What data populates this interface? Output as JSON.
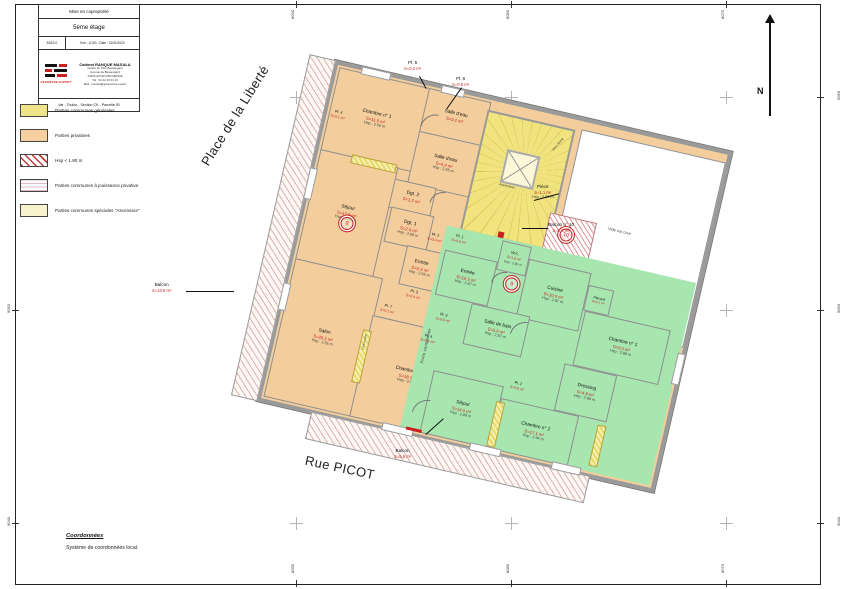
{
  "title_block": {
    "project": "Mise en copropriété",
    "floor": "5ème étage",
    "dossier": "5323.0",
    "scale_date": "Ech : 1/100 - Date : 21/01/2020",
    "firm": "Cabinet RANQUE MASALA",
    "address": [
      "Centre du Parc Beauregard",
      "Avenue de Beauregard",
      "13100 AIX EN PROVENCE",
      "Tél : 04 42 23 01 10",
      "Mail : contact@geometres.expert"
    ],
    "logo_label": "GÉOMÈTRE-EXPERT",
    "location": "Var - Toulon - Section CK - Parcelle 30"
  },
  "legend": {
    "items": [
      {
        "label": "Parties communes générales",
        "color": "#efe488"
      },
      {
        "label": "Parties privatives",
        "color": "#f5cf9e"
      },
      {
        "label": "Hsp < 1.80 m",
        "color": "hatch-red"
      },
      {
        "label": "Parties communes à jouissance privative",
        "color": "lines-pink"
      },
      {
        "label": "Parties communes spéciales \"Ascenseur\"",
        "color": "#f8f2cd"
      }
    ]
  },
  "streets": {
    "top": "Place de la Liberté",
    "bottom": "Rue PICOT"
  },
  "north_label": "N",
  "grid": {
    "x_labels": [
      "8090",
      "8080",
      "8070"
    ],
    "y_left": [
      "9050",
      "9040"
    ],
    "y_right": [
      "9060",
      "9050",
      "9040"
    ]
  },
  "coordinates_note": {
    "title": "Coordonnées",
    "text": "Système de coordonnées local."
  },
  "lots": {
    "l8": "8",
    "l9": "9",
    "l10": "10"
  },
  "labels": {
    "ascenseur": "Ascenseur",
    "vers_etage": "Vers 4ème",
    "vide": "Vide sur cour",
    "porte_condamnee": "Porte condamnée",
    "cheminee": "Cheminée"
  },
  "rooms": {
    "chambre1_o": {
      "name": "Chambre n° 1",
      "area": "S=11.5 m²",
      "hsp": "Hsp : 2.56 m"
    },
    "salle_eau1": {
      "name": "Salle d'eau",
      "area": "S=3.2 m²"
    },
    "salle_eau2": {
      "name": "Salle d'eau",
      "area": "S=4.4 m²",
      "hsp": "Hsp : 2.55 m"
    },
    "dgt2": {
      "name": "Dgt. 2",
      "area": "S=1.2 m²"
    },
    "dgt1": {
      "name": "Dgt. 1",
      "area": "S=2.9 m²",
      "hsp": "Hsp : 2.95 m"
    },
    "sejour_o": {
      "name": "Séjour",
      "area": "S=17.6 m²",
      "hsp": "Hsp : 2.56 m"
    },
    "entree_o": {
      "name": "Entrée",
      "area": "S=2.4 m²",
      "hsp": "Hsp : 2.95 m"
    },
    "salon": {
      "name": "Salon",
      "area": "S=25.2 m²",
      "hsp": "Hsp : 2.55 m"
    },
    "chambre2_o": {
      "name": "Chambre n° 2",
      "area": "S=18.1 m²",
      "hsp": "Hsp : 2.55 m"
    },
    "piece": {
      "name": "Pièce",
      "area": "S=1.1 m²",
      "hsp": "Hsp : 2.55 m"
    },
    "entree_g": {
      "name": "Entrée",
      "area": "S=10.3 m²",
      "hsp": "Hsp : 2.87 m"
    },
    "wc": {
      "name": "W.C.",
      "area": "S=1.5 m²",
      "hsp": "Hsp : 2.86 m"
    },
    "cuisine": {
      "name": "Cuisine",
      "area": "S=10.0 m²",
      "hsp": "Hsp : 2.87 m"
    },
    "placard": {
      "name": "Placard",
      "area": "S=0.1 m²"
    },
    "chambre1_g": {
      "name": "Chambre n° 1",
      "area": "S=9.2 m²",
      "hsp": "Hsp : 2.88 m"
    },
    "dressing": {
      "name": "Dressing",
      "area": "S=4.8 m²",
      "hsp": "Hsp : 2.88 m"
    },
    "salle_bain": {
      "name": "Salle de bain",
      "area": "S=5.6 m²",
      "hsp": "Hsp : 2.87 m"
    },
    "sejour_g": {
      "name": "Séjour",
      "area": "S=14.0 m²",
      "hsp": "Hsp : 2.89 m"
    },
    "chambre2_g": {
      "name": "Chambre n° 2",
      "area": "S=17.1 m²",
      "hsp": "Hsp : 2.94 m"
    }
  },
  "closets": {
    "pl4_o": {
      "name": "Pl. 4",
      "area": "S=0.1 m²"
    },
    "pl5_o": {
      "name": "Pl. 5",
      "area": "S=0.2 m²"
    },
    "pl6_o": {
      "name": "Pl. 6",
      "area": "S=0.5 m²"
    },
    "pl2_o": {
      "name": "Pl. 2",
      "area": "S=0.4 m²"
    },
    "pl3_o": {
      "name": "Pl. 3",
      "area": "S=0.4 m²"
    },
    "pl7_o": {
      "name": "Pl. 7",
      "area": "S=0.1 m²"
    },
    "pl1_g": {
      "name": "Pl. 1",
      "area": "S=0.5 m²"
    },
    "pl2_g": {
      "name": "Pl. 2",
      "area": "S=0.6 m²"
    },
    "pl3_g": {
      "name": "Pl. 3",
      "area": "S=0.6 m²"
    },
    "pl4_g": {
      "name": "Pl. 4",
      "area": "S=0.5 m²"
    }
  },
  "balconies": {
    "balcon_left": {
      "name": "Balcon",
      "area": "S=10.6 m²"
    },
    "balcon_bottom": {
      "name": "Balcon",
      "area": "S=5.6 m²"
    },
    "balcon10": {
      "name": "Balcon n° 10",
      "area": "S=1.3 m²"
    }
  }
}
